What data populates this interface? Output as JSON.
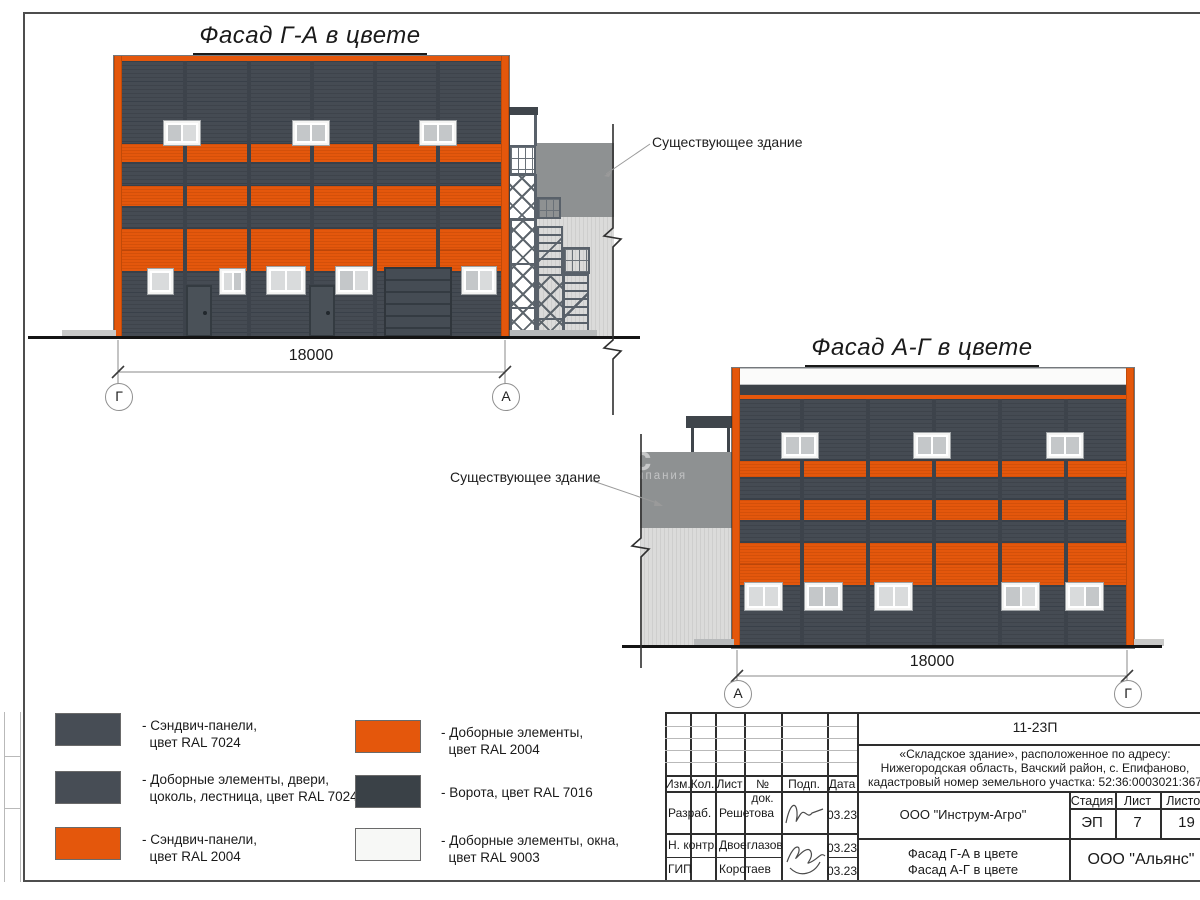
{
  "facade1": {
    "title": "Фасад Г-А в цвете",
    "dimension": "18000",
    "axis_left": "Г",
    "axis_right": "А",
    "existing_label": "Существующее здание"
  },
  "facade2": {
    "title": "Фасад А-Г в цвете",
    "dimension": "18000",
    "axis_left": "А",
    "axis_right": "Г",
    "existing_label": "Существующее здание"
  },
  "watermark": {
    "line1": "нс",
    "line2": "компания"
  },
  "legend": {
    "items": [
      {
        "color": "#474D55",
        "line1": "- Сэндвич-панели,",
        "line2": "  цвет RAL 7024"
      },
      {
        "color": "#474D55",
        "line1": "- Доборные элементы, двери,",
        "line2": "  цоколь, лестница, цвет RAL 7024"
      },
      {
        "color": "#E4570C",
        "line1": "- Сэндвич-панели,",
        "line2": "  цвет RAL 2004"
      },
      {
        "color": "#E4570C",
        "line1": "- Доборные элементы,",
        "line2": "  цвет RAL 2004"
      },
      {
        "color": "#3A4147",
        "line1": "- Ворота, цвет RAL 7016",
        "line2": ""
      },
      {
        "color": "#F7F8F6",
        "line1": "- Доборные элементы, окна,",
        "line2": "  цвет RAL 9003"
      }
    ]
  },
  "titleblock": {
    "doc_number": "11-23П",
    "desc1": "«Складское здание», расположенное по адресу:",
    "desc2": "Нижегородская область, Вачский район, с. Епифаново,",
    "desc3": "кадастровый номер земельного участка: 52:36:0003021:367",
    "col_izm": "Изм.",
    "col_kol": "Кол.",
    "col_list": "Лист",
    "col_doc": "№ док.",
    "col_podp": "Подп.",
    "col_data": "Дата",
    "row1_role": "Разраб.",
    "row1_name": "Решетова",
    "row1_date": "03.23",
    "row2_role": "Н. контр.",
    "row2_name": "Двоеглазов",
    "row2_date": "03.23",
    "row3_role": "ГИП",
    "row3_name": "Коротаев",
    "row3_date": "03.23",
    "designer": "ООО \"Инструм-Агро\"",
    "stage_label": "Стадия",
    "sheet_label": "Лист",
    "sheets_label": "Листов",
    "stage": "ЭП",
    "sheet": "7",
    "sheets": "19",
    "name_line1": "Фасад Г-А в цвете",
    "name_line2": "Фасад А-Г в цвете",
    "firm": "ООО \"Альянс\""
  },
  "colors": {
    "orange_ral2004": "#E4570C",
    "panel_ral7024": "#474D55",
    "gate_ral7016": "#3A4147",
    "window_ral9003": "#F7F8F6",
    "frame": "#4D4D4D"
  }
}
